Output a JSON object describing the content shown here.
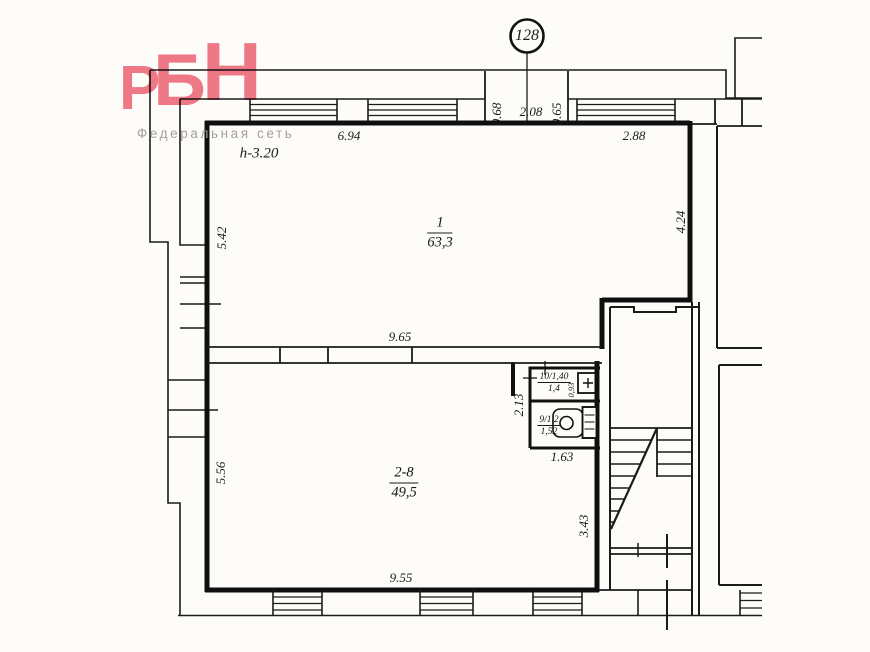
{
  "logo": {
    "letter_1": "Р",
    "letter_2": "Б",
    "letter_3": "Н",
    "subtitle": "Федеральная сеть",
    "brand_color": "#ef6e7e",
    "subtitle_color": "#a3a09d"
  },
  "unit_badge": {
    "number": "128"
  },
  "rooms": {
    "room_1": {
      "number": "1",
      "area": "63,3",
      "ceiling_height": "h-3.20"
    },
    "room_2_8": {
      "number": "2-8",
      "area": "49,5"
    },
    "room_10": {
      "label": "10/1,40",
      "width": "1,4",
      "depth": "0,93"
    },
    "room_9": {
      "label": "9/1,2",
      "width": "1,52"
    }
  },
  "dimensions": {
    "top_window_run": "6.94",
    "entry_left": "0.68",
    "entry_width": "2.08",
    "entry_right": "0.65",
    "top_right_window": "2.88",
    "left_upper": "5.42",
    "right_upper": "4.24",
    "middle_width": "9.65",
    "wc_lobby_depth": "2.13",
    "wc_width": "1.63",
    "left_lower": "5.56",
    "right_lower": "3.43",
    "bottom_width": "9.55"
  },
  "drawing": {
    "line_color": "#1b1b1b",
    "wall_color": "#0f0f0f",
    "paper_color": "#fdfcf9"
  }
}
